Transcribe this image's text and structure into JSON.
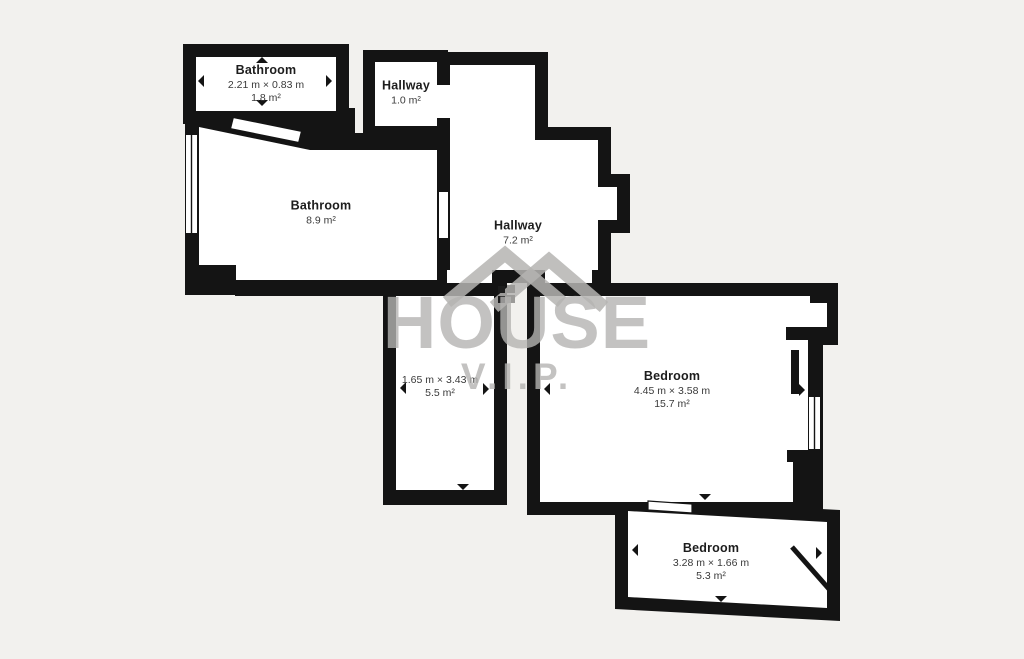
{
  "watermark": {
    "brand_line1": "HOUSE",
    "brand_line2": "V.I.P."
  },
  "rooms": [
    {
      "name": "Bathroom",
      "dimensions": "2.21 m × 0.83 m",
      "area": "1.8 m²"
    },
    {
      "name": "Hallway",
      "area": "1.0 m²"
    },
    {
      "name": "Bathroom",
      "area": "8.9 m²"
    },
    {
      "name": "Hallway",
      "area": "7.2 m²"
    },
    {
      "name": "",
      "dimensions": "1.65 m × 3.43 m",
      "area": "5.5 m²"
    },
    {
      "name": "Bedroom",
      "dimensions": "4.45 m × 3.58 m",
      "area": "15.7 m²"
    },
    {
      "name": "Bedroom",
      "dimensions": "3.28 m × 1.66 m",
      "area": "5.3 m²"
    }
  ],
  "colors": {
    "background": "#f2f1ee",
    "wall": "#141414",
    "room_fill": "#ffffff",
    "watermark": "#b5b4b2"
  }
}
